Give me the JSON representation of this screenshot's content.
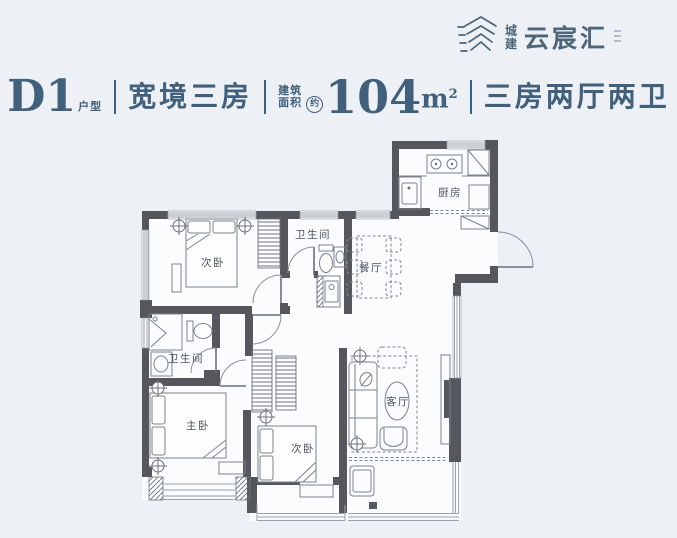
{
  "page": {
    "bg": "#edf1f6",
    "accent": "#40607b"
  },
  "logo": {
    "brand_char1": "城",
    "brand_char2": "建",
    "name": "云宸汇"
  },
  "header": {
    "unit_code": "D1",
    "unit_suffix": "户型",
    "title": "宽境三房",
    "area_label_line1": "建筑",
    "area_label_line2": "面积",
    "area_approx": "约",
    "area_value": "104",
    "area_unit": "m",
    "area_unit_sup": "2",
    "divider_glyph": "",
    "layout": "三房两厅两卫"
  },
  "floorplan": {
    "rooms": [
      {
        "id": "bedroom-top",
        "label": "次卧"
      },
      {
        "id": "bath-top",
        "label": "卫生间"
      },
      {
        "id": "kitchen",
        "label": "厨房"
      },
      {
        "id": "dining",
        "label": "餐厅"
      },
      {
        "id": "bath-left",
        "label": "卫生间"
      },
      {
        "id": "master-bedroom",
        "label": "主卧"
      },
      {
        "id": "bedroom-bottom",
        "label": "次卧"
      },
      {
        "id": "living",
        "label": "客厅"
      }
    ]
  }
}
